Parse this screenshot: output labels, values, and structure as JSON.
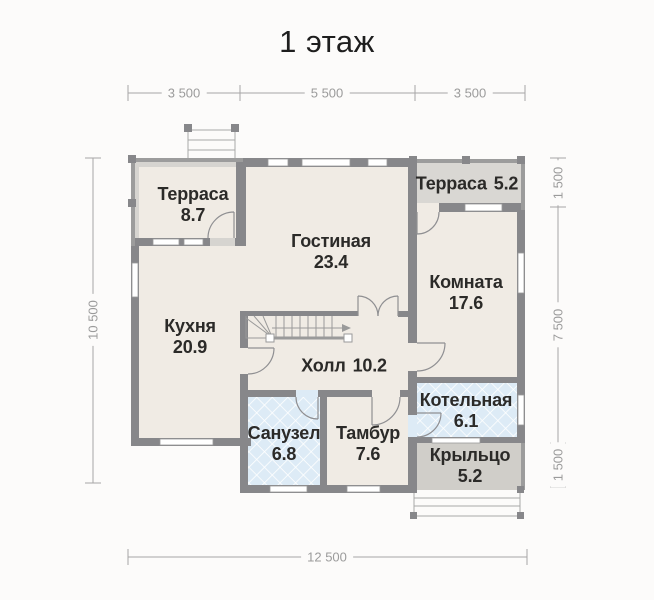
{
  "title": "1 этаж",
  "rooms": [
    {
      "id": "terrace-tl",
      "name": "Терраса",
      "area": "8.7"
    },
    {
      "id": "living",
      "name": "Гостиная",
      "area": "23.4"
    },
    {
      "id": "terrace-tr",
      "name": "Терраса",
      "area": "5.2"
    },
    {
      "id": "room",
      "name": "Комната",
      "area": "17.6"
    },
    {
      "id": "kitchen",
      "name": "Кухня",
      "area": "20.9"
    },
    {
      "id": "hall",
      "name": "Холл",
      "area": "10.2"
    },
    {
      "id": "bathroom",
      "name": "Санузел",
      "area": "6.8"
    },
    {
      "id": "vestibule",
      "name": "Тамбур",
      "area": "7.6"
    },
    {
      "id": "boiler",
      "name": "Котельная",
      "area": "6.1"
    },
    {
      "id": "porch",
      "name": "Крыльцо",
      "area": "5.2"
    }
  ],
  "dimensions": {
    "top": [
      "3 500",
      "5 500",
      "3 500"
    ],
    "left": [
      "10 500"
    ],
    "right": [
      "1 500",
      "7 500",
      "1 500"
    ],
    "bottom": [
      "12 500"
    ]
  },
  "colors": {
    "wall": "#87878a",
    "thin_wall": "#9c9c9c",
    "floor": "#f0ebe4",
    "terrace": "#d6d4d0",
    "porch": "#d0cec9",
    "tile": "#ddebf6",
    "dimension": "#9b9b9b",
    "text": "#2b2a28"
  }
}
